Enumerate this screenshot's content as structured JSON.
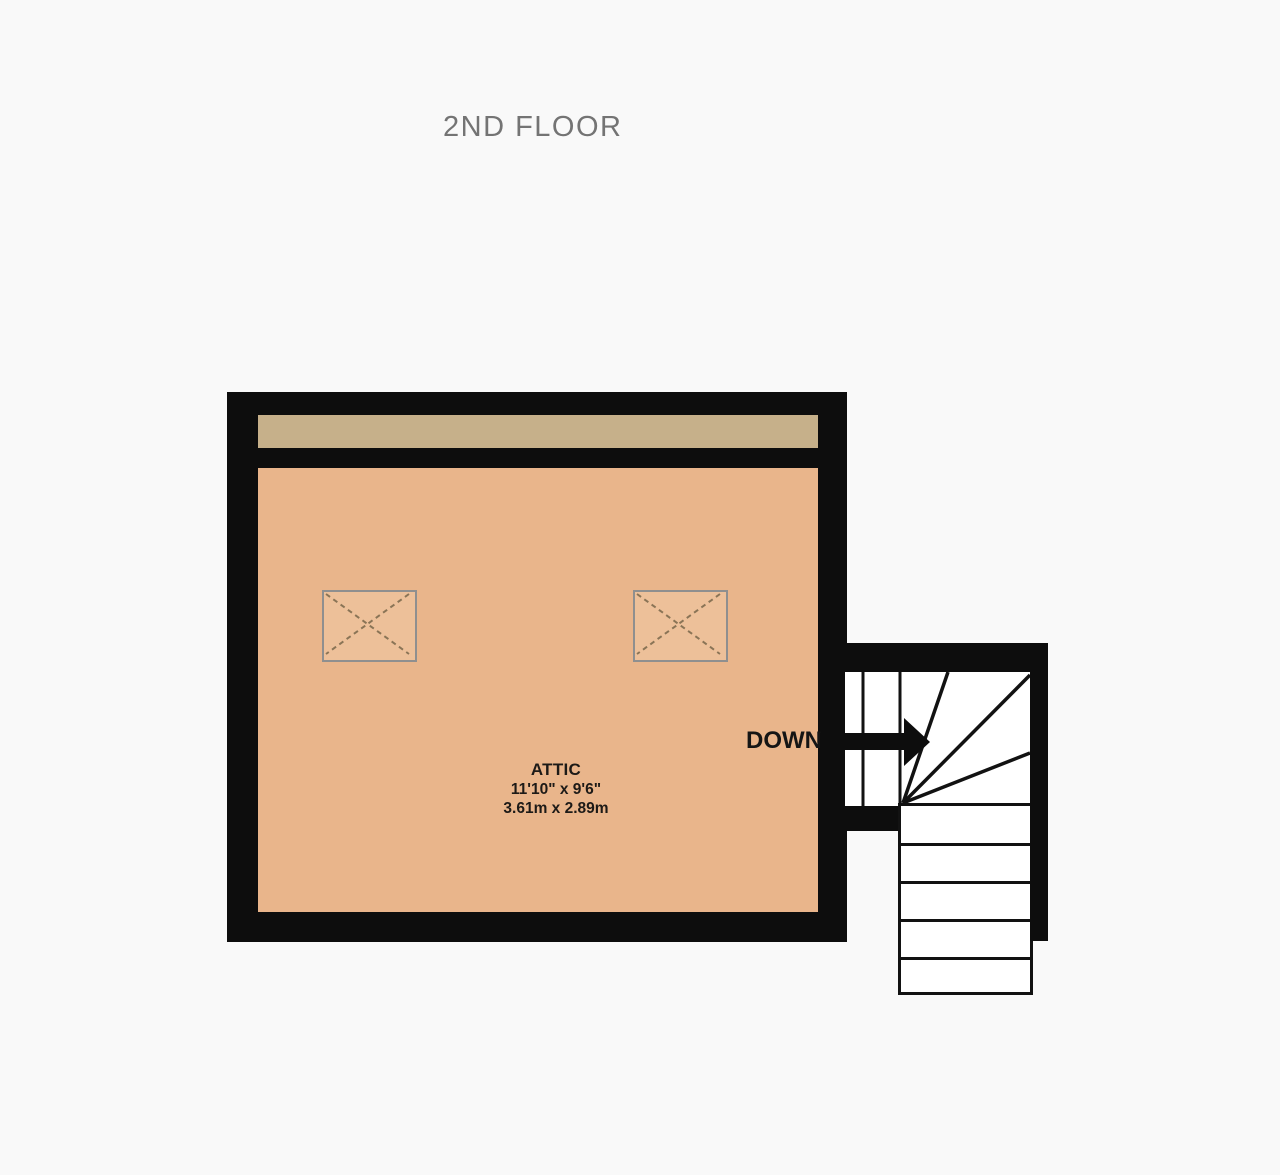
{
  "page": {
    "title": "2ND FLOOR",
    "background_color": "#f9f9f9",
    "title_color": "#747474"
  },
  "floorplan": {
    "colors": {
      "wall": "#0d0d0d",
      "room_fill": "#e9b58b",
      "ceiling_strip_fill": "#c6b08a",
      "stair_fill": "#ffffff",
      "skylight_fill": "#edc099",
      "skylight_border": "#8f8f8f",
      "skylight_dash": "#8a7456",
      "label_color": "#1d1a17"
    },
    "room": {
      "name": "ATTIC",
      "dimensions_imperial": "11'10\"  x 9'6\"",
      "dimensions_metric": "3.61m  x 2.89m"
    },
    "skylights": {
      "count": 2
    },
    "stairs": {
      "direction_label": "DOWN",
      "straight_treads": 5,
      "winder_treads": 4,
      "entry_treads": 2
    }
  }
}
